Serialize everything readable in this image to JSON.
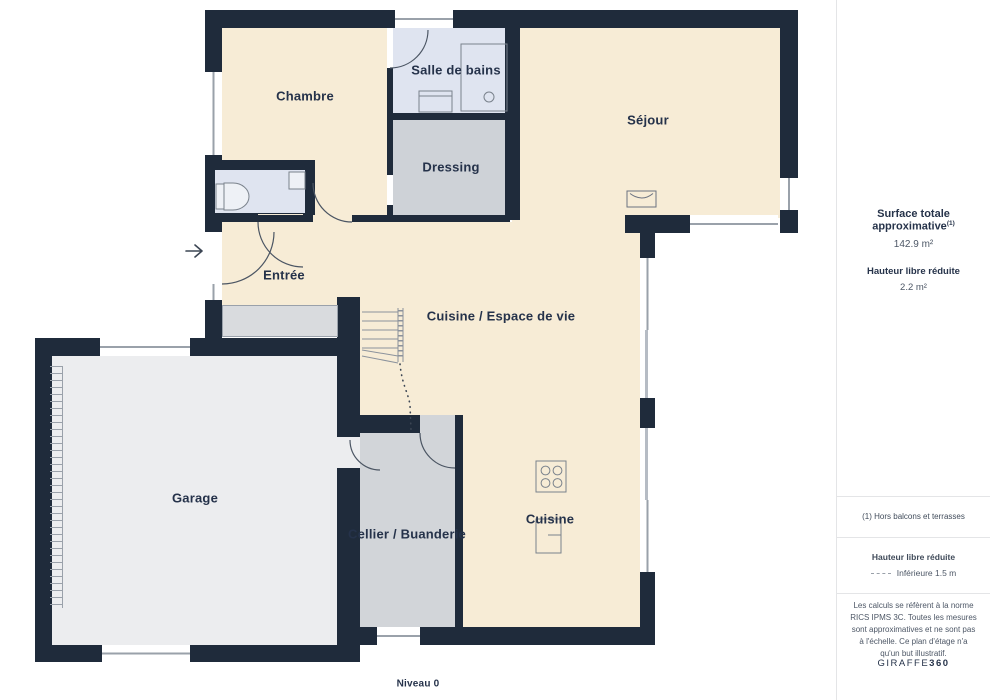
{
  "plan": {
    "level_label": "Niveau 0",
    "rooms": [
      {
        "id": "chambre",
        "label": "Chambre"
      },
      {
        "id": "salle-de-bains",
        "label": "Salle de bains"
      },
      {
        "id": "dressing",
        "label": "Dressing"
      },
      {
        "id": "sejour",
        "label": "Séjour"
      },
      {
        "id": "entree",
        "label": "Entrée"
      },
      {
        "id": "cuisine-espace-de-vie",
        "label": "Cuisine / Espace de vie"
      },
      {
        "id": "garage",
        "label": "Garage"
      },
      {
        "id": "cellier-buanderie",
        "label": "Cellier / Buanderie"
      },
      {
        "id": "cuisine",
        "label": "Cuisine"
      }
    ],
    "colors": {
      "wall": "#1f2b3b",
      "floor_main": "#f7ecd6",
      "floor_bath": "#dfe4f0",
      "floor_dressing": "#ced2d7",
      "floor_garage": "#ecedef",
      "text": "#25324a"
    }
  },
  "sidebar": {
    "surface_title": "Surface totale approximative",
    "surface_sup": "(1)",
    "surface_value": "142.9 m²",
    "height_title": "Hauteur libre réduite",
    "height_value": "2.2 m²",
    "footnote": "(1) Hors balcons et terrasses",
    "legend_title": "Hauteur libre réduite",
    "legend_item": "Inférieure 1.5 m",
    "disclaimer": "Les calculs se réfèrent à la norme RICS IPMS 3C. Toutes les mesures sont approximatives et ne sont pas à l'échelle. Ce plan d'étage n'a qu'un but illustratif.",
    "brand": "GIRAFFE",
    "brand_suffix": "360"
  }
}
